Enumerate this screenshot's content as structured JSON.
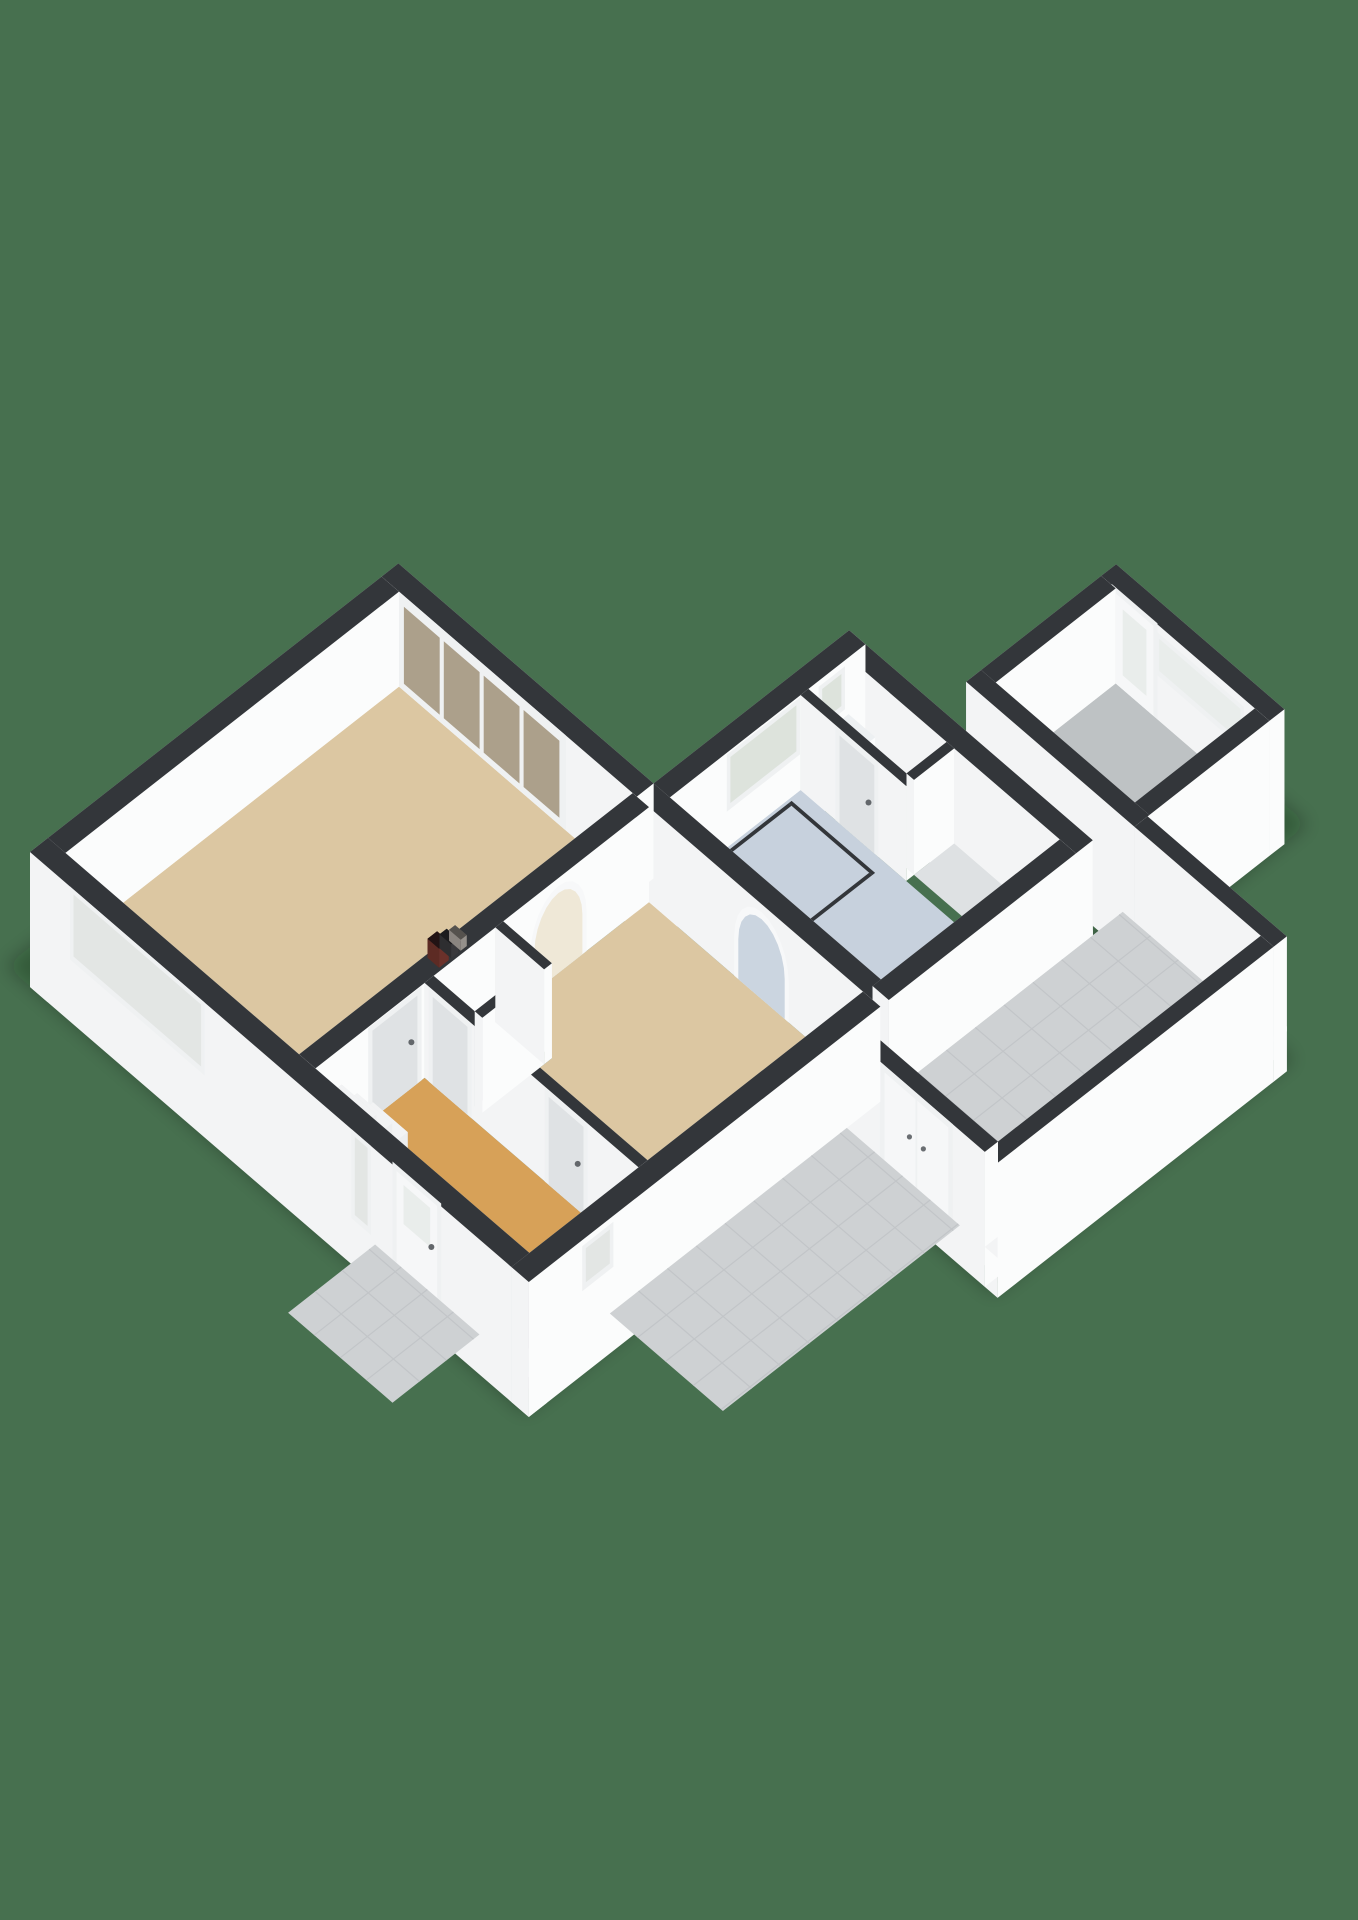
{
  "title": "3d-floorplan-ground-floor",
  "colors": {
    "background": "#47704F",
    "wallTop": "#33363A",
    "wallBright": "#F3F4F5",
    "wallLight": "#FBFCFC",
    "wallShade": "#D3D6D8",
    "wallMid": "#E6E8E9",
    "frame": "#EFF1F2",
    "reveal": "#F7F8F9",
    "doorWhite": "#F6F7F8",
    "doorShade": "#DFE2E4",
    "glassClear": "#E3E6E4",
    "glassTan": "#ACA08B",
    "glassFrost": "#E9EDEB",
    "glassBath": "#DDE3DC",
    "floorLiving": "#DCC7A2",
    "floorHall": "#D7A158",
    "floorCloset": "#D9DADB",
    "floorBath": "#C7D1DD",
    "floorRearHall": "#DEE1E3",
    "floorGarage": "#BEC2C4",
    "floorPatio": "#CED1D3",
    "patioLine": "#C2C5C8",
    "archBeyondWarm": "#EFE8D7",
    "archBeyondBlue": "#CBD5E0",
    "meterRed": "#5D2B24",
    "meterDark": "#2E2E30",
    "meterGray": "#8A8580",
    "fixtureWhite": "#FBFCFD",
    "stepTop": "#F2F3F4",
    "showerGlass": "rgba(233,239,243,0.55)",
    "shadow": "rgba(10,25,14,0.28)"
  },
  "rooms": [
    {
      "name": "living-room",
      "floor": "floorLiving"
    },
    {
      "name": "dining-room",
      "floor": "floorLiving"
    },
    {
      "name": "entrance-hall",
      "floor": "floorHall"
    },
    {
      "name": "meter-closet",
      "floor": "floorCloset"
    },
    {
      "name": "bathroom",
      "floor": "floorBath"
    },
    {
      "name": "toilet",
      "floor": "floorBath"
    },
    {
      "name": "rear-hall",
      "floor": "floorRearHall"
    },
    {
      "name": "patio",
      "floor": "floorPatio"
    },
    {
      "name": "garage",
      "floor": "floorGarage"
    }
  ],
  "scene": {
    "origin": [
      30,
      947
    ],
    "ax": [
      58,
      50
    ],
    "ay": [
      60,
      -47
    ],
    "hz": 100,
    "wall_h": 0.95,
    "skirt": 0.4,
    "shadows": [
      {
        "name": "house-shadow",
        "pts": [
          [
            0,
            -0.4
          ],
          [
            8.95,
            -0.4
          ],
          [
            8.95,
            6.1
          ],
          [
            0,
            6.1
          ]
        ]
      },
      {
        "name": "garage-shadow",
        "pts": [
          [
            5.9,
            9.8
          ],
          [
            9.2,
            9.8
          ],
          [
            9.2,
            12.4
          ],
          [
            5.9,
            12.4
          ]
        ]
      },
      {
        "name": "patio-shadow",
        "pts": [
          [
            8.6,
            4.9
          ],
          [
            11.55,
            4.9
          ],
          [
            11.55,
            9.9
          ],
          [
            8.6,
            9.9
          ]
        ]
      }
    ],
    "floors": [
      {
        "name": "living-room-floor",
        "box": [
          0.3,
          4.33,
          0.3,
          5.86
        ],
        "fill": "floorLiving"
      },
      {
        "name": "hall-floor",
        "box": [
          4.61,
          8.3,
          0.3,
          2.12
        ],
        "fill": "floorHall"
      },
      {
        "name": "dining-room-floor",
        "pts": [
          [
            4.61,
            3.43
          ],
          [
            4.61,
            5.86
          ],
          [
            8.3,
            5.86
          ],
          [
            8.3,
            2.27
          ],
          [
            5.45,
            2.27
          ],
          [
            5.45,
            3.43
          ]
        ],
        "fill": "floorLiving"
      },
      {
        "name": "meter-closet-floor",
        "box": [
          4.61,
          5.32,
          2.27,
          3.3
        ],
        "fill": "floorCloset"
      },
      {
        "name": "bathroom-floor",
        "box": [
          4.68,
          8.32,
          6.14,
          8.32
        ],
        "fill": "floorBath"
      },
      {
        "name": "toilet-floor",
        "box": [
          4.68,
          6.37,
          8.45,
          9.12
        ],
        "fill": "floorBath"
      },
      {
        "name": "rear-hall-floor",
        "box": [
          6.5,
          8.32,
          8.45,
          9.12
        ],
        "fill": "floorRearHall"
      },
      {
        "name": "garage-floor",
        "box": [
          6.15,
          8.55,
          10.15,
          12.15
        ],
        "fill": "floorGarage"
      },
      {
        "name": "patio-floor",
        "box": [
          8.6,
          10.98,
          5.52,
          9.9
        ],
        "fill": "floorPatio",
        "grid": 0.48
      }
    ],
    "items": [
      {
        "t": "wall",
        "name": "garage-back-wall",
        "box": [
          5.9,
          8.8,
          12.15,
          12.4
        ],
        "skirt": true,
        "openings": [
          {
            "type": "window",
            "face": "-y",
            "u1": 6.9,
            "u2": 8.3,
            "z1": 0.5,
            "z2": 0.82,
            "glass": "glassFrost",
            "name": "garage-slit-window"
          },
          {
            "type": "door",
            "face": "-y",
            "u1": 6.15,
            "u2": 6.8,
            "z2": 0.9,
            "glass": [
              6.27,
              6.68,
              0.14,
              0.8
            ],
            "name": "garage-back-door"
          }
        ]
      },
      {
        "t": "wall",
        "name": "garage-left-wall",
        "box": [
          5.9,
          6.15,
          9.9,
          12.15
        ],
        "skirt": true
      },
      {
        "t": "wall",
        "name": "garage-right-wall",
        "box": [
          8.55,
          8.8,
          9.9,
          12.15
        ],
        "skirt": true
      },
      {
        "t": "wall",
        "name": "garage-front-wall",
        "box": [
          5.9,
          8.8,
          9.9,
          10.15
        ],
        "skirt": true
      },
      {
        "t": "wall",
        "name": "garden-wall-ne",
        "box": [
          8.8,
          11.2,
          9.9,
          10.12
        ],
        "skirt": true
      },
      {
        "t": "wall",
        "name": "wing-ne-wall",
        "box": [
          4.4,
          8.6,
          9.12,
          9.4
        ],
        "skirt": true
      },
      {
        "t": "wall",
        "name": "wing-nw-wall",
        "box": [
          4.4,
          4.68,
          6.0,
          9.4
        ],
        "skirt": true,
        "openings": [
          {
            "type": "window",
            "face": "+x",
            "u1": 7.15,
            "u2": 8.25,
            "z1": 0.42,
            "z2": 0.88,
            "glass": "glassBath",
            "name": "bathroom-window"
          },
          {
            "type": "window",
            "face": "+x",
            "u1": 8.68,
            "u2": 9.0,
            "z1": 0.52,
            "z2": 0.84,
            "glass": "glassBath",
            "name": "toilet-window"
          }
        ]
      },
      {
        "t": "box",
        "name": "toilet-fixture",
        "box": [
          4.72,
          5.18,
          8.68,
          9.08
        ],
        "z1": 0.42,
        "fills": {
          "mx": "#E8EAEC",
          "py": "#F0F2F3",
          "px": "#FBFCFD",
          "my": "#FDFDFE"
        },
        "topFill": "#EDF0F2"
      },
      {
        "t": "wall",
        "name": "bathroom-partition",
        "box": [
          4.68,
          6.5,
          8.32,
          8.45
        ],
        "openings": [
          {
            "type": "door",
            "face": "-y",
            "u1": 5.35,
            "u2": 5.95,
            "z2": 0.88,
            "shade": true,
            "handle": true,
            "name": "toilet-door"
          }
        ]
      },
      {
        "t": "wall",
        "name": "toilet-partition",
        "box": [
          6.37,
          6.5,
          8.45,
          9.12
        ]
      },
      {
        "t": "box",
        "name": "shower-panel-back",
        "box": [
          4.72,
          6.16,
          8.08,
          8.13
        ],
        "glass": true
      },
      {
        "t": "box",
        "name": "shower-panel-left",
        "box": [
          4.72,
          4.77,
          6.78,
          8.08
        ],
        "glass": true
      },
      {
        "t": "box",
        "name": "shower-panel-right",
        "box": [
          6.11,
          6.16,
          6.78,
          8.08
        ],
        "glass": true
      },
      {
        "t": "box",
        "name": "shower-panel-front",
        "box": [
          4.72,
          6.16,
          6.78,
          6.83
        ],
        "glass": true
      },
      {
        "t": "wall",
        "name": "dining-bathroom-wall",
        "box": [
          4.4,
          8.6,
          5.86,
          6.14
        ],
        "openings": [
          {
            "type": "arch",
            "face": "-y",
            "u1": 6.15,
            "u2": 6.95,
            "zTop": 0.8,
            "fill": "archBeyondBlue",
            "name": "arch-to-bathroom"
          }
        ]
      },
      {
        "t": "wall",
        "name": "wing-se-wall",
        "box": [
          8.32,
          8.6,
          6.0,
          9.12
        ],
        "skirt": true
      },
      {
        "t": "wall",
        "name": "garden-wall-se",
        "box": [
          10.98,
          11.2,
          5.3,
          9.9
        ],
        "skirt": true
      },
      {
        "t": "wall",
        "name": "garden-wall-gate",
        "box": [
          8.6,
          10.98,
          5.3,
          5.52
        ],
        "skirt": true,
        "openings": [
          {
            "type": "doubledoor",
            "face": "-y",
            "u1": 9.25,
            "u2": 10.35,
            "z2": 0.88,
            "name": "garden-gate"
          }
        ]
      },
      {
        "t": "wall",
        "name": "house-ne-facade",
        "box": [
          0,
          4.4,
          5.86,
          6.14
        ],
        "skirt": true,
        "openings": [
          {
            "type": "slider",
            "face": "-y",
            "u1": 0.35,
            "u2": 3.1,
            "z2": 0.88,
            "panels": 4,
            "name": "sliding-door"
          }
        ]
      },
      {
        "t": "wall",
        "name": "house-nw-facade",
        "box": [
          0,
          0.3,
          0,
          5.86
        ],
        "skirt": true
      },
      {
        "t": "wall",
        "name": "living-hall-divider",
        "box": [
          4.33,
          4.61,
          0.3,
          5.86
        ],
        "openings": [
          {
            "type": "door",
            "face": "+x",
            "u1": 1.25,
            "u2": 2.0,
            "z2": 0.88,
            "shade": true,
            "handle": true,
            "name": "living-room-door"
          },
          {
            "type": "arch",
            "face": "+x",
            "u1": 3.95,
            "u2": 4.75,
            "zTop": 0.8,
            "fill": "archBeyondWarm",
            "name": "arch-to-living"
          }
        ]
      },
      {
        "t": "box",
        "name": "meter-box-1",
        "box": [
          4.37,
          4.57,
          2.4,
          2.56
        ],
        "z0": 0.95,
        "z1": 1.14,
        "fills": {
          "mx": "#4A211B",
          "py": "#552620",
          "px": "#6B312A",
          "my": "#5D2B24"
        },
        "topFill": "#221314"
      },
      {
        "t": "box",
        "name": "meter-box-2",
        "box": [
          4.37,
          4.57,
          2.6,
          2.72
        ],
        "z0": 0.95,
        "z1": 1.09,
        "fills": {
          "mx": "#232325",
          "py": "#2A2A2C",
          "px": "#39393C",
          "my": "#2E2E30"
        },
        "topFill": "#1C1C1E"
      },
      {
        "t": "box",
        "name": "meter-box-3",
        "box": [
          4.37,
          4.57,
          2.76,
          2.86
        ],
        "z0": 0.95,
        "z1": 1.06,
        "fills": {
          "mx": "#6E6A66",
          "py": "#7B7772",
          "px": "#94908B",
          "my": "#8A8580"
        },
        "topFill": "#55524E"
      },
      {
        "t": "wall",
        "name": "hall-ne-wall",
        "box": [
          4.61,
          8.3,
          2.12,
          2.27
        ],
        "openings": [
          {
            "type": "door",
            "face": "-y",
            "u1": 4.75,
            "u2": 5.35,
            "z2": 0.88,
            "shade": true,
            "name": "meter-closet-door"
          },
          {
            "type": "door",
            "face": "-y",
            "u1": 6.75,
            "u2": 7.35,
            "z2": 0.88,
            "shade": true,
            "handle": true,
            "name": "dining-room-door"
          }
        ]
      },
      {
        "t": "wall",
        "name": "meter-closet-e-wall",
        "box": [
          5.32,
          5.45,
          2.27,
          3.3
        ]
      },
      {
        "t": "wall",
        "name": "meter-closet-n-wall",
        "box": [
          4.61,
          5.45,
          3.3,
          3.43
        ]
      },
      {
        "t": "box",
        "name": "stair-step-1",
        "box": [
          4.66,
          5.26,
          0.95,
          1.21
        ],
        "z1": 0.21,
        "fills": {
          "mx": "#DADCDD",
          "py": "#E8EAEB",
          "px": "#EDEEEF",
          "my": "#FFFFFF"
        },
        "topFill": "stepTop"
      },
      {
        "t": "box",
        "name": "stair-step-2",
        "box": [
          4.66,
          5.26,
          0.69,
          0.95
        ],
        "z1": 0.42,
        "fills": {
          "mx": "#DADCDD",
          "py": "#E8EAEB",
          "px": "#EDEEEF",
          "my": "#FFFFFF"
        },
        "topFill": "stepTop"
      },
      {
        "t": "box",
        "name": "stair-step-3",
        "box": [
          4.66,
          5.26,
          0.43,
          0.69
        ],
        "z1": 0.63,
        "fills": {
          "mx": "#DADCDD",
          "py": "#E8EAEB",
          "px": "#EDEEEF",
          "my": "#FFFFFF"
        },
        "topFill": "stepTop"
      },
      {
        "t": "wall",
        "name": "house-sw-facade",
        "box": [
          0,
          8.6,
          0,
          0.3
        ],
        "skirt": true,
        "openings": [
          {
            "type": "window",
            "face": "-y",
            "u1": 0.75,
            "u2": 2.95,
            "z1": 0.28,
            "z2": 0.9,
            "glass": "glassClear",
            "name": "living-room-window"
          },
          {
            "type": "window",
            "face": "-y",
            "u1": 5.6,
            "u2": 5.82,
            "z1": 0.12,
            "z2": 0.9,
            "glass": "glassClear",
            "name": "door-sidelight-window"
          },
          {
            "type": "door",
            "face": "-y",
            "u1": 6.32,
            "u2": 7.02,
            "z2": 0.92,
            "glass": [
              6.44,
              6.9,
              0.45,
              0.84
            ],
            "handle": true,
            "name": "front-door"
          }
        ]
      },
      {
        "t": "wall",
        "name": "house-se-facade",
        "box": [
          8.3,
          8.6,
          0,
          5.86
        ],
        "skirt": true,
        "openings": [
          {
            "type": "window",
            "face": "+x",
            "u1": 0.95,
            "u2": 1.35,
            "z1": 0.5,
            "z2": 0.84,
            "glass": "glassClear",
            "name": "hall-side-window"
          }
        ]
      },
      {
        "t": "floor",
        "name": "stoop-tiles",
        "box": [
          5.95,
          7.75,
          -1.45,
          0
        ],
        "fill": "floorPatio",
        "grid": 0.45
      },
      {
        "t": "floor",
        "name": "lower-patio-tiles",
        "box": [
          8.6,
          10.55,
          1.35,
          5.3
        ],
        "fill": "floorPatio",
        "grid": 0.48
      }
    ]
  }
}
